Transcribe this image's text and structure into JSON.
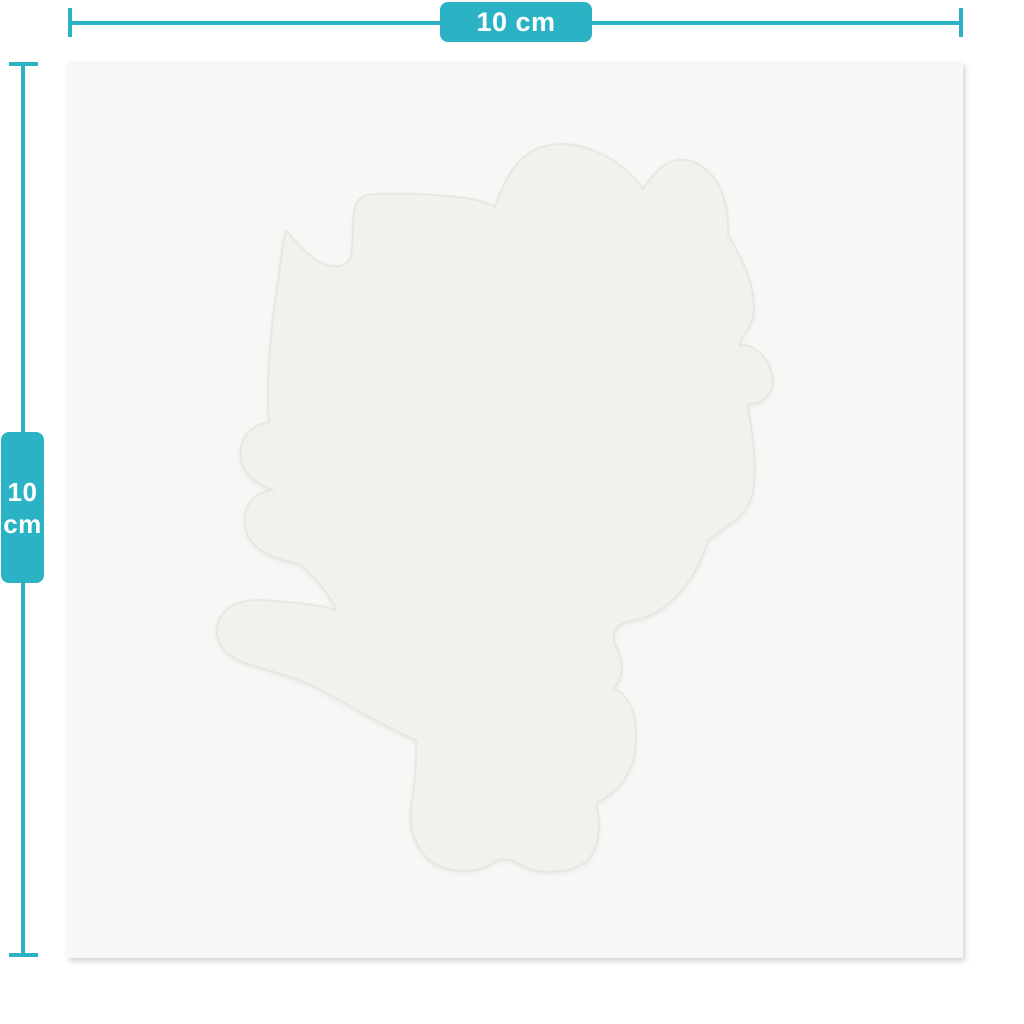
{
  "page": {
    "type": "product-dimensions-preview"
  },
  "colors": {
    "accent": "#2bb3c5",
    "page-bg": "#ffffff",
    "badge-text": "#ffffff",
    "sheet-bg": "#f7f7f5",
    "silhouette-fill": "#f1f1ee",
    "silhouette-edge": "#e4e4e0"
  },
  "dimension_annotations": {
    "horizontal": {
      "label": "10 cm"
    },
    "vertical": {
      "value": "10",
      "unit": "cm"
    }
  },
  "sheet": {
    "silhouette_icon": "die-cut-character-silhouette"
  }
}
